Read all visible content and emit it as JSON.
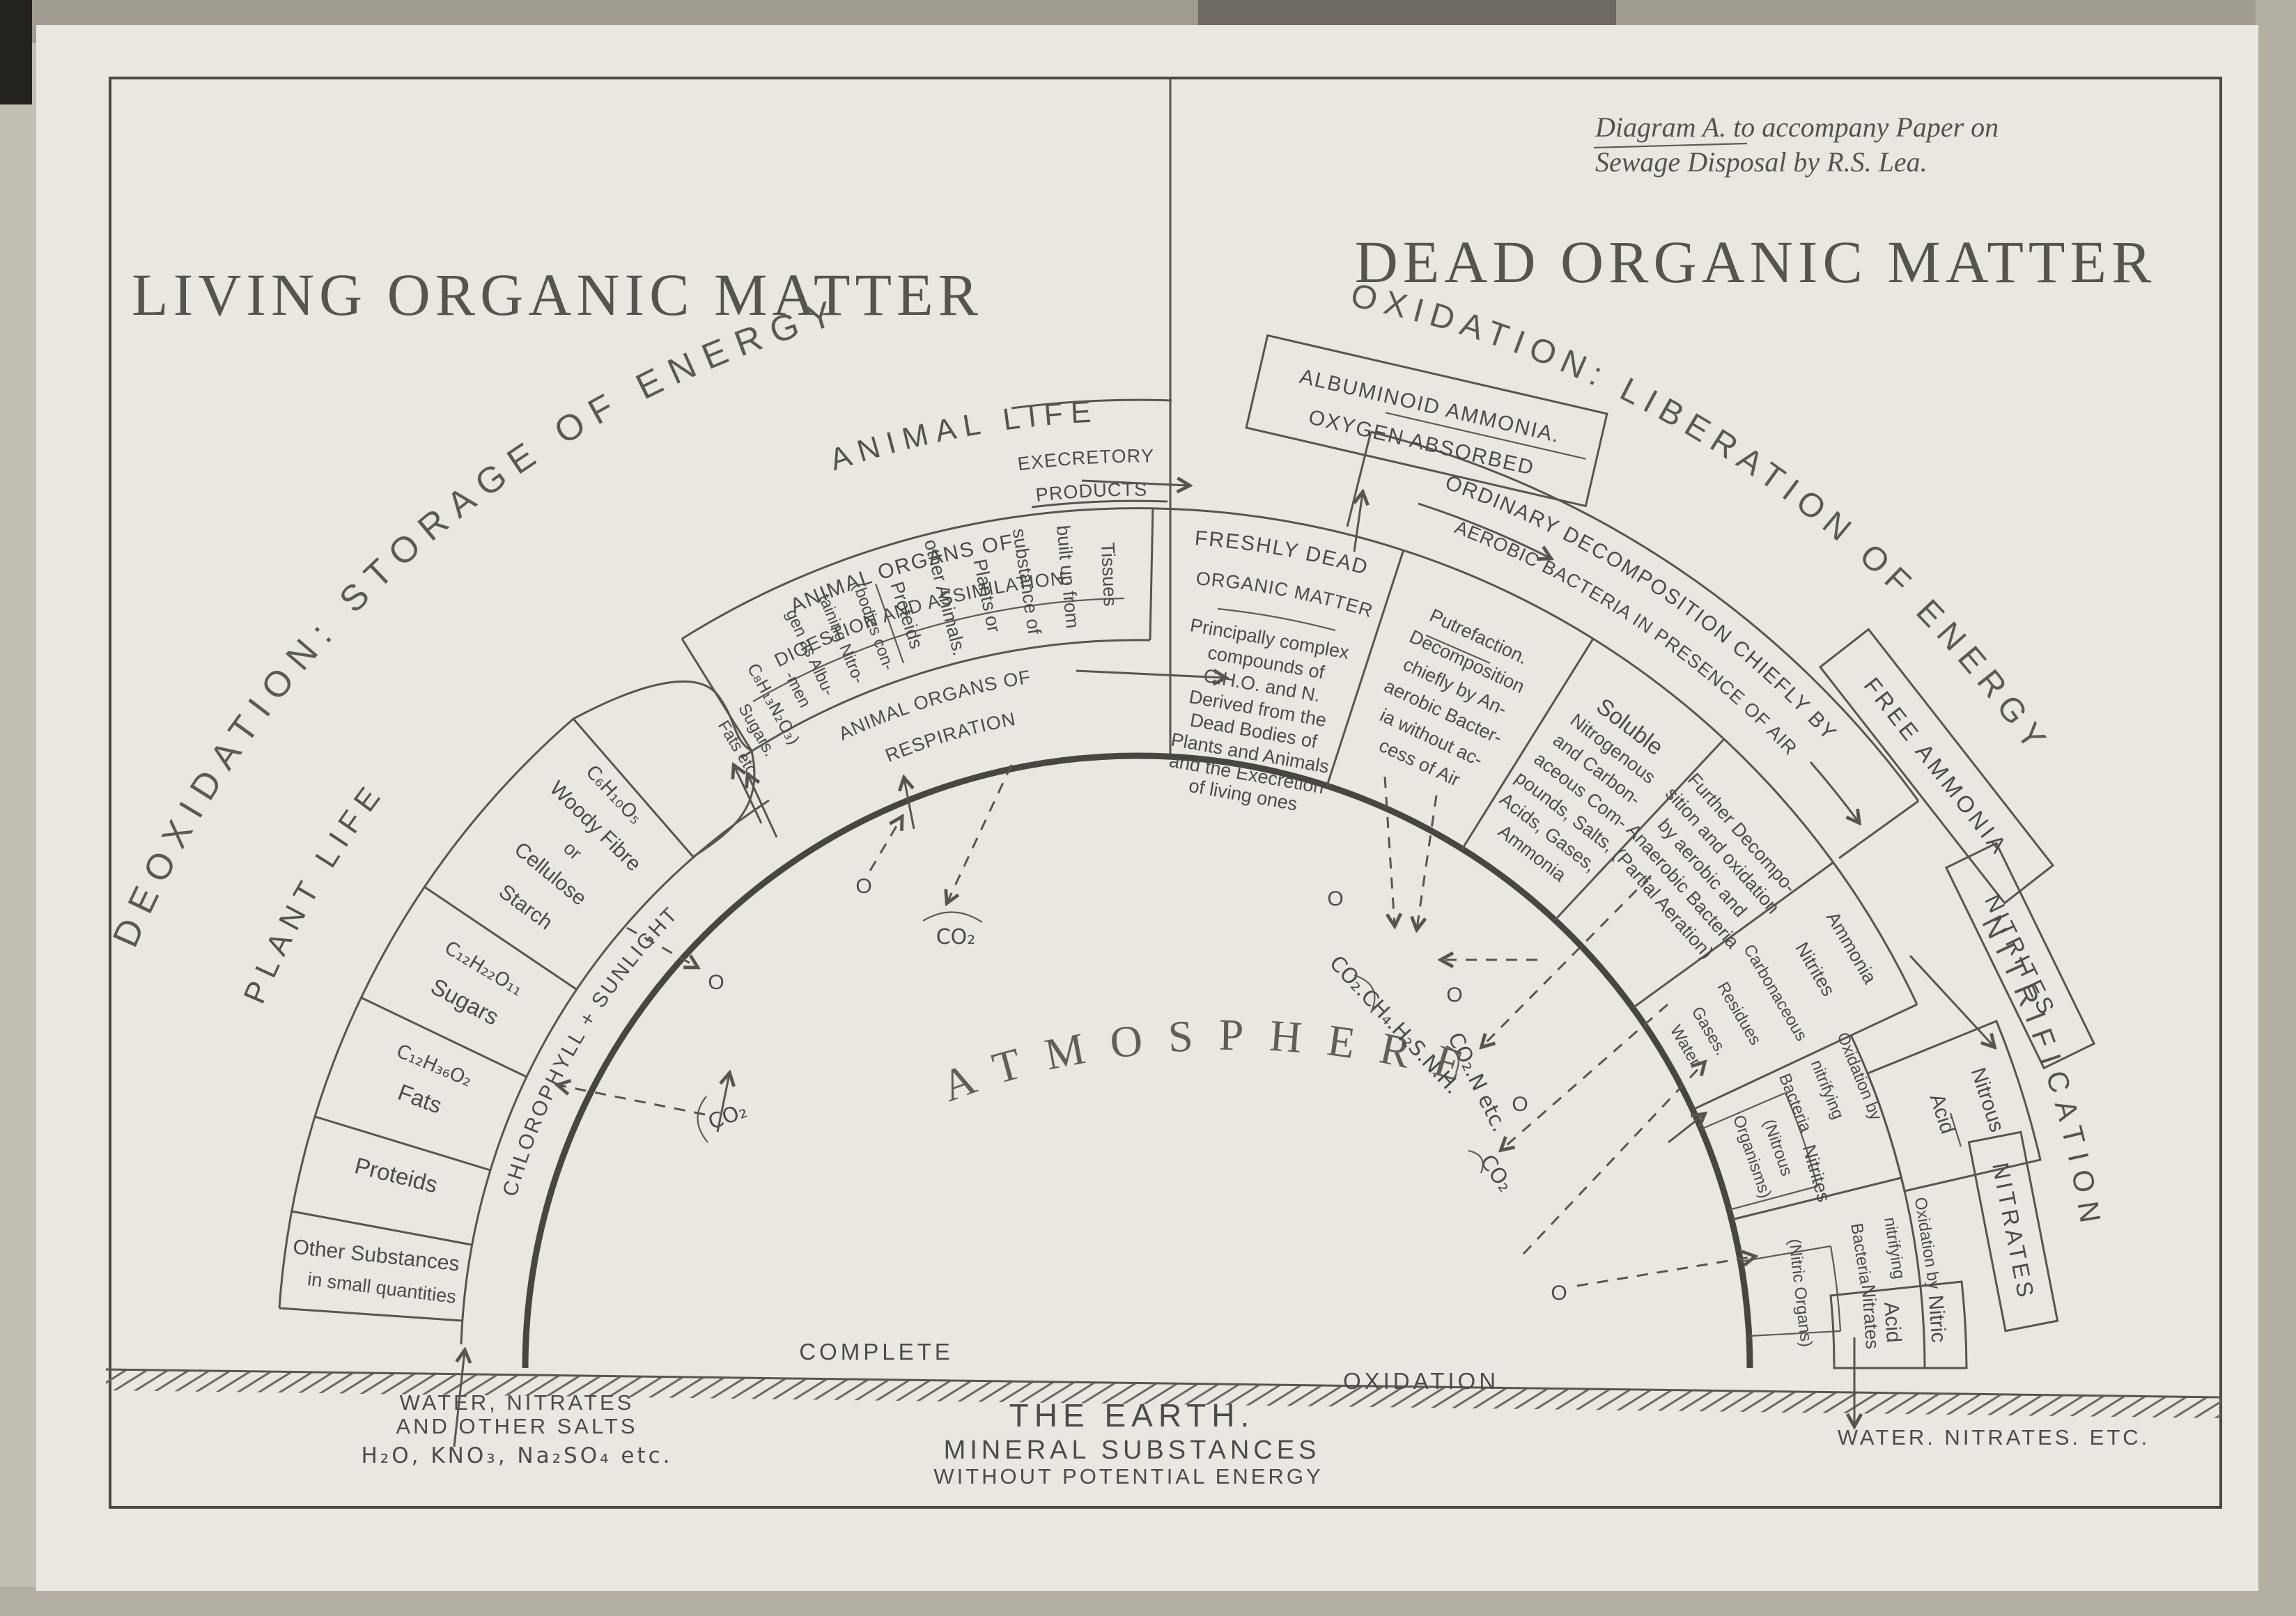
{
  "caption": {
    "line1": "Diagram A. to accompany Paper on",
    "line2": "Sewage Disposal by R.S. Lea."
  },
  "titles": {
    "left": "LIVING ORGANIC MATTER",
    "right": "DEAD ORGANIC MATTER"
  },
  "arc_labels": {
    "deoxidation": "DEOXIDATION: STORAGE OF ENERGY",
    "oxidation": "OXIDATION: LIBERATION OF ENERGY",
    "plant_life": "PLANT LIFE",
    "animal_life": "ANIMAL LIFE",
    "atmosphere": "ATMOSPHERE",
    "nitrification": "NITRIFICATION",
    "chlorophyll": "CHLOROPHYLL + SUNLIGHT"
  },
  "plant": {
    "sectors": [
      {
        "l0": "Starch",
        "l1": "Cellulose",
        "l2": "or",
        "l3": "Woody Fibre",
        "formula": "C₆H₁₀O₅"
      },
      {
        "l0": "Sugars",
        "formula": "C₁₂H₂₂O₁₁"
      },
      {
        "l0": "Fats",
        "formula": "C₁₂H₃₆O₂"
      },
      {
        "l0": "Proteids"
      },
      {
        "l0": "Other Substances",
        "l1": "in small quantities"
      }
    ]
  },
  "digestion": {
    "title1": "ANIMAL ORGANS OF",
    "title2": "DIGESTION AND ASSIMILATION.",
    "lines": [
      "Tissues",
      "built up from",
      "substance of",
      "Plants or",
      "other Animals.",
      "Proteids",
      "(bodies con-",
      "taining Nitro-",
      "gen as Albu-",
      "-men",
      "C₈H₁₃N₂O₃)",
      "Sugars.",
      "Fats etc."
    ]
  },
  "respiration": {
    "title1": "ANIMAL ORGANS OF",
    "title2": "RESPIRATION"
  },
  "excretory": {
    "line1": "EXECRETORY",
    "line2": "PRODUCTS"
  },
  "albuminoid": {
    "line1": "ALBUMINOID AMMONIA.",
    "line2": "OXYGEN ABSORBED"
  },
  "freshly_dead": {
    "title1": "FRESHLY DEAD",
    "title2": "ORGANIC MATTER",
    "lines": [
      "Principally complex",
      "compounds of",
      "C.H.O. and N.",
      "Derived from the",
      "Dead Bodies of",
      "Plants and Animals",
      "and the Execretion",
      "of living ones"
    ]
  },
  "ordinary": {
    "line1": "ORDINARY DECOMPOSITION CHIEFLY BY",
    "line2": "AEROBIC BACTERIA IN PRESENCE OF AIR"
  },
  "putrefaction": {
    "lines": [
      "Putrefaction.",
      "Decomposition",
      "chiefly by An-",
      "aerobic Bacter-",
      "ia without ac-",
      "cess of Air"
    ]
  },
  "soluble": {
    "lines": [
      "Soluble",
      "Nitrogenous",
      "and Carbon-",
      "aceous Com-",
      "pounds, Salts,",
      "Acids, Gases,",
      "Ammonia"
    ]
  },
  "further": {
    "lines": [
      "Further Decompo-",
      "sition and oxidation",
      "by aerobic and",
      "Anaerobic Bacteria",
      "(Partial Aeration)"
    ]
  },
  "products_rows": {
    "lines": [
      "Ammonia",
      "Nitrites",
      "Carbonaceous",
      "Residues",
      "Gases.",
      "Water"
    ]
  },
  "nitrous": {
    "ox0": "Oxidation by",
    "ox1": "nitrifying",
    "ox2": "Bacteria",
    "organisms1": "(Nitrous",
    "organisms2": "Organisms)",
    "nitrites": "Nitrites",
    "acid1": "Nitrous",
    "acid2": "Acid"
  },
  "nitric": {
    "ox0": "Oxidation by",
    "ox1": "nitrifying",
    "ox2": "Bacteria",
    "organisms": "(Nitric Organs)",
    "nitrates": "Nitrates",
    "acid1": "Nitric",
    "acid2": "Acid"
  },
  "stage_boxes": {
    "free_ammonia": "FREE AMMONIA",
    "nitrites": "NITRITES",
    "nitrates": "NITRATES"
  },
  "ground": {
    "complete": "COMPLETE",
    "oxidation": "OXIDATION",
    "earth1": "THE EARTH.",
    "earth2": "MINERAL SUBSTANCES",
    "earth3": "WITHOUT POTENTIAL ENERGY",
    "left1": "WATER, NITRATES",
    "left2": "AND OTHER SALTS",
    "left3": "H₂O, KNO₃, Na₂SO₄ etc.",
    "right": "WATER. NITRATES. ETC."
  },
  "gases": {
    "o": "O",
    "co2": "CO₂",
    "putrefaction_mix": "CO₂.CH₄.H₂S.N.H.",
    "partial_mix": "CO₂.N etc."
  },
  "colors": {
    "ink": "#4c4b45",
    "paper": "#e9e7e0"
  }
}
